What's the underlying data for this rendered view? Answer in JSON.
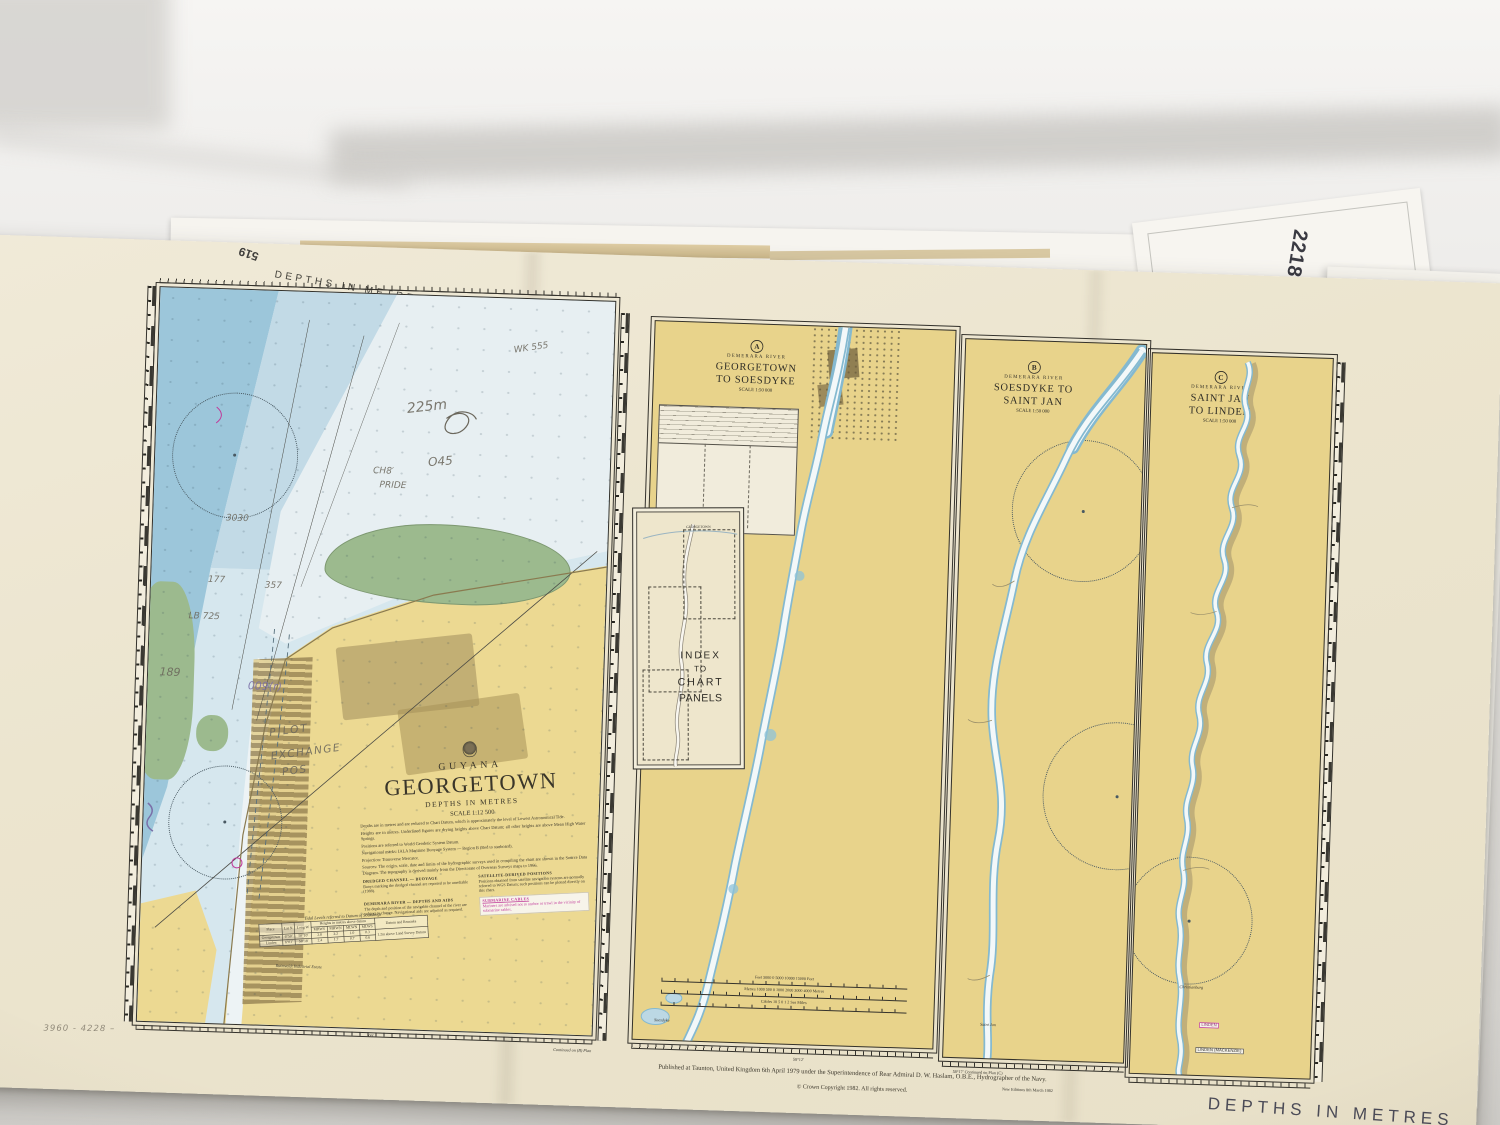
{
  "colors": {
    "paper": "#ece5cf",
    "land": "#e8d38b",
    "water_deep": "#9cc6da",
    "water_light": "#e7eff2",
    "green": "#9cba8e",
    "urban": "#a08b5e",
    "magenta": "#c0399a",
    "pencil": "#6b675c",
    "ink": "#34322c"
  },
  "sheet": {
    "top_border_label": "DEPTHS IN METRES",
    "bottom_border_label": "DEPTHS IN METRES",
    "chart_number": "519",
    "underlying_chart_number": "2218"
  },
  "georgetown_chart": {
    "title_block": {
      "country": "GUYANA",
      "title": "GEORGETOWN",
      "depths": "DEPTHS IN METRES",
      "scale": "SCALE 1:12 500",
      "notes": [
        "Depths are in metres and are reduced to Chart Datum, which is approximately the level of Lowest Astronomical Tide.",
        "Heights are in metres. Underlined figures are drying heights above Chart Datum; all other heights are above Mean High Water Springs.",
        "Positions are referred to World Geodetic System Datum.",
        "Navigational marks: IALA Maritime Buoyage System — Region B (Red to starboard).",
        "Projection: Transverse Mercator.",
        "Sources: The origin, scale, date and limits of the hydrographic surveys used in compiling the chart are shown in the Source Data Diagram. The topography is derived mainly from the Directorate of Overseas Surveys maps to 1966."
      ],
      "sections": [
        {
          "heading": "DREDGED CHANNEL — BUOYAGE",
          "body": "Buoys marking the dredged channel are reported to be unreliable (1988)."
        },
        {
          "heading": "DEMERARA RIVER — DEPTHS AND AIDS",
          "body": "The depth and position of the navigable channel of the river are subject to change. Navigational aids are adjusted as required."
        },
        {
          "heading": "SATELLITE-DERIVED POSITIONS",
          "body": "Positions obtained from satellite navigation systems are normally referred to WGS Datum; such positions can be plotted directly on this chart."
        },
        {
          "heading": "SUBMARINE CABLES",
          "body": "Mariners are advised not to anchor or trawl in the vicinity of submarine cables."
        }
      ]
    },
    "tidal_table": {
      "title": "Tidal Levels referred to Datum of Soundings",
      "col_place": "Place",
      "col_lat": "Lat N",
      "col_long": "Long W",
      "col_heights": "Heights in metres above datum",
      "col_remarks": "Datum and Remarks",
      "subcols": [
        "MHWS",
        "MHWN",
        "MLWN",
        "MLWS"
      ],
      "rows": [
        {
          "place": "Georgetown",
          "lat": "6°50′",
          "long": "58°10′",
          "mhws": "2.8",
          "mhwn": "2.2",
          "mlwn": "1.0",
          "mlws": "0.3"
        },
        {
          "place": "Linden",
          "lat": "6°01′",
          "long": "58°18′",
          "mhws": "2.4",
          "mhwn": "1.7",
          "mlwn": "0.7",
          "mlws": "0.6"
        }
      ],
      "remark": "1.2m above Land Survey Datum"
    },
    "place_label": "Ruimveldt Industrial Estate"
  },
  "panels": [
    {
      "letter": "A",
      "region": "DEMERARA RIVER",
      "title": "GEORGETOWN TO SOESDYKE",
      "scale": "SCALE 1:50 000",
      "bottom_label": "Soesdyke"
    },
    {
      "letter": "B",
      "region": "DEMERARA RIVER",
      "title": "SOESDYKE TO SAINT JAN",
      "scale": "SCALE 1:50 000",
      "bottom_label": "Saint Jan"
    },
    {
      "letter": "C",
      "region": "DEMERARA RIVER",
      "title": "SAINT JAN TO LINDEN",
      "scale": "SCALE 1:50 000",
      "labels": {
        "christianburg": "Christianburg",
        "linden": "LINDEN",
        "linden_mackenzie": "LINDEN (MACKENZIE)"
      }
    }
  ],
  "index_inset": {
    "top_label": "GEORGETOWN",
    "lines": [
      "INDEX",
      "TO",
      "CHART",
      "PANELS"
    ]
  },
  "scale_bars": [
    {
      "text": "Feet 5000 0 5000 10000 15000 Feet"
    },
    {
      "text": "Metres 1000 500 0 1000 2000 3000 4000 Metres"
    },
    {
      "text": "Cables 10 5 0 1 2 Sea Miles"
    }
  ],
  "footer": {
    "published": "Published at Taunton, United Kingdom 6th April 1979 under the Superintendence of Rear Admiral D. W. Haslam, O.B.E., Hydrographer of the Navy.",
    "copyright": "© Crown Copyright 1982. All rights reserved.",
    "new_editions": "New Editions 8th March 1982",
    "continued_b": "Continued on (B) Plan",
    "longitude_a": "58°12′",
    "continued_c": "58°17′   Continued on Plan (C)",
    "tick": "09′"
  },
  "annotations": [
    {
      "text": "WK 555"
    },
    {
      "text": "225m"
    },
    {
      "text": "O45"
    },
    {
      "text": "CH8′"
    },
    {
      "text": "PRIDE"
    },
    {
      "text": "3030"
    },
    {
      "text": "357"
    },
    {
      "text": "177"
    },
    {
      "text": "LB 725"
    },
    {
      "text": "189"
    },
    {
      "text": "009(r)"
    },
    {
      "text": "PILOT"
    },
    {
      "text": "EXCHANGE"
    },
    {
      "text": "POS"
    },
    {
      "text": "3960 - 4228 –"
    }
  ]
}
